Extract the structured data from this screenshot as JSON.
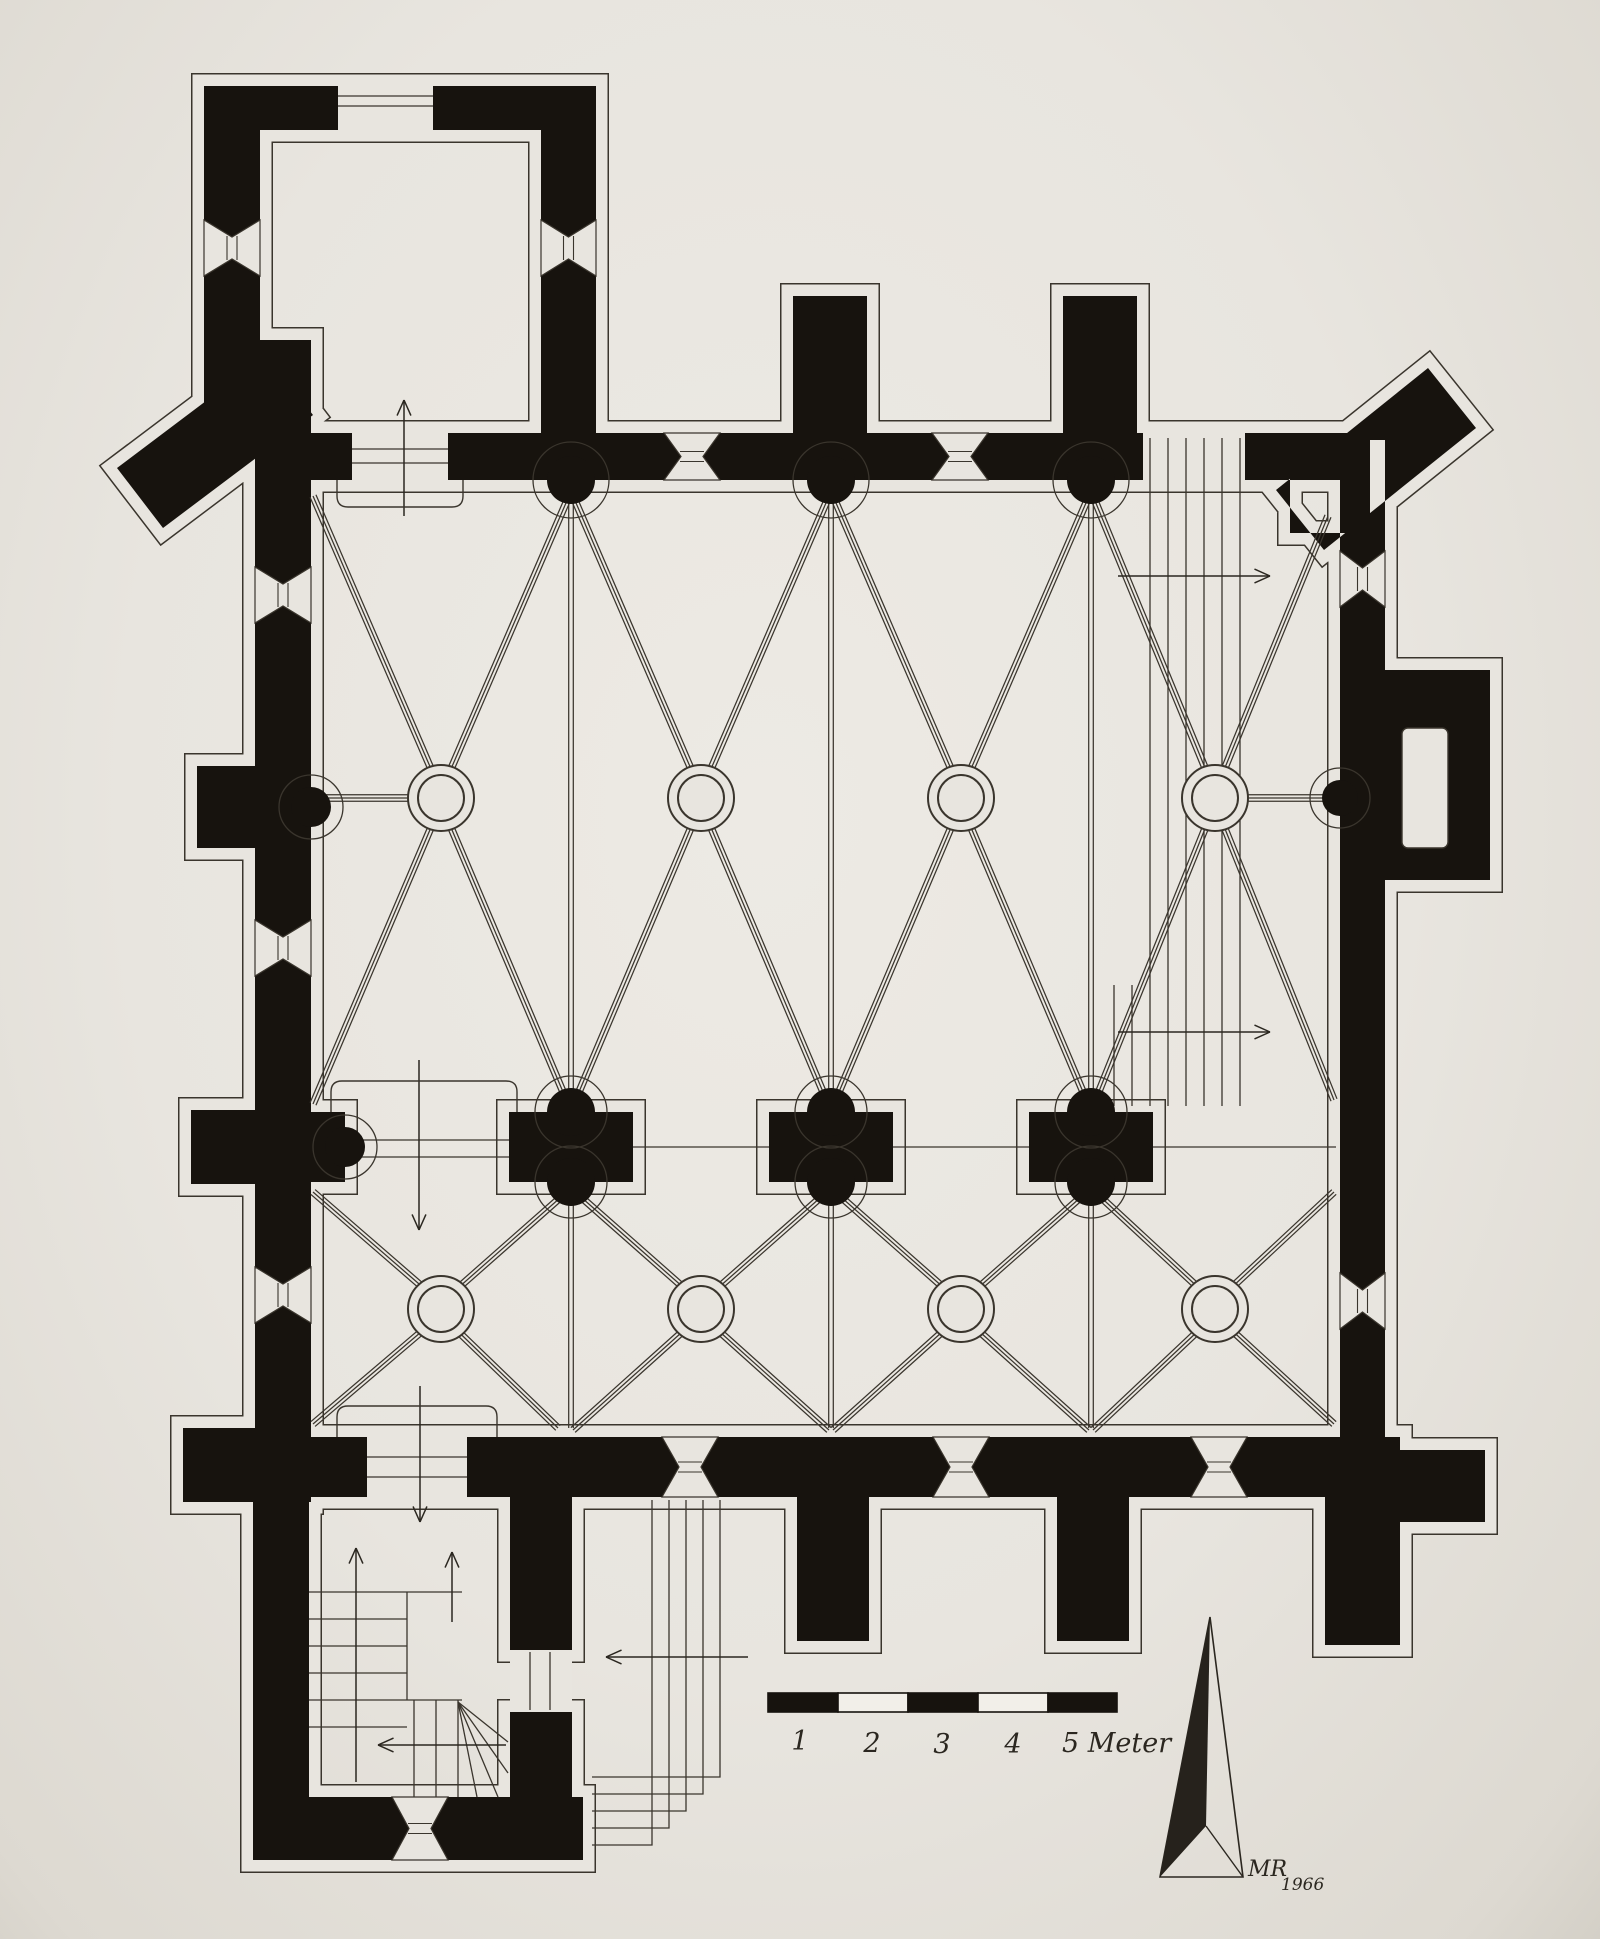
{
  "drawing": {
    "kind": "church-floor-plan",
    "colors": {
      "paper": "#e8e5df",
      "ink": "#17130e",
      "line": "#3a352d"
    }
  },
  "scale_bar": {
    "labels": [
      "1",
      "2",
      "3",
      "4",
      "5 Meter"
    ]
  },
  "signature": {
    "monogram": "MR",
    "year": "1966"
  }
}
